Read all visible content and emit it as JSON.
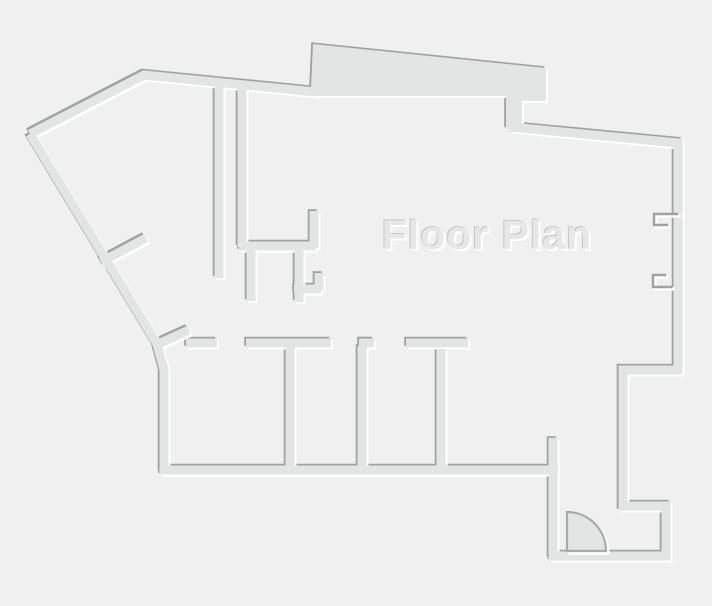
{
  "title": "Floor Plan",
  "colors": {
    "background": "#f0f0f1",
    "wall_fill": "#e3e5e5",
    "edge_dark": "#a1a1a2",
    "edge_light": "#ffffff",
    "title_fill": "#e7e7e7",
    "title_shadow_dark": "#c6c6c6",
    "title_shadow_light": "#ffffff"
  },
  "floorplan": {
    "wall_thickness": 9,
    "emboss_offset_dark": "-1.8,-1.8",
    "emboss_offset_light": "2,2",
    "wall_paths": [
      "M 30 134 L 144 75 L 316 92",
      "M 30 134 L 157 344 L 164 370 L 164 472",
      "M 160 470 L 558 470",
      "M 510 127 L 678 143 L 678 370 L 623 370 L 623 506 L 666 506 L 666 556 L 549 556",
      "M 553 438 L 553 558",
      "M 156 345 L 189 330",
      "M 186 343 L 217 343",
      "M 246 343 L 331 343",
      "M 359 343 L 374 343",
      "M 406 343 L 468 343",
      "M 290 346 L 290 469",
      "M 362 346 L 362 469",
      "M 441 349 L 441 469",
      "M 219 85 L 219 278",
      "M 242 86 L 242 247",
      "M 239 246 L 316 246",
      "M 314 211 L 314 248",
      "M 251 247 L 251 301",
      "M 299 247 L 299 302",
      "M 294 289 L 321 289",
      "M 319 273 L 319 290",
      "M 101 262 L 146 238"
    ],
    "slab_path": "M 311 88 L 313 44 L 546 68 L 546 101 L 522 101 L 522 129 L 506 129 L 506 96 L 311 96 Z",
    "door_swing_path": "M 567 551 L 567 512 A 39 39 0 0 1 606 551 Z",
    "window_brackets": [
      "M 677 214 L 654 214 L 654 225 L 667 225",
      "M 665 275 L 653 275 L 653 287 L 671 287"
    ]
  }
}
